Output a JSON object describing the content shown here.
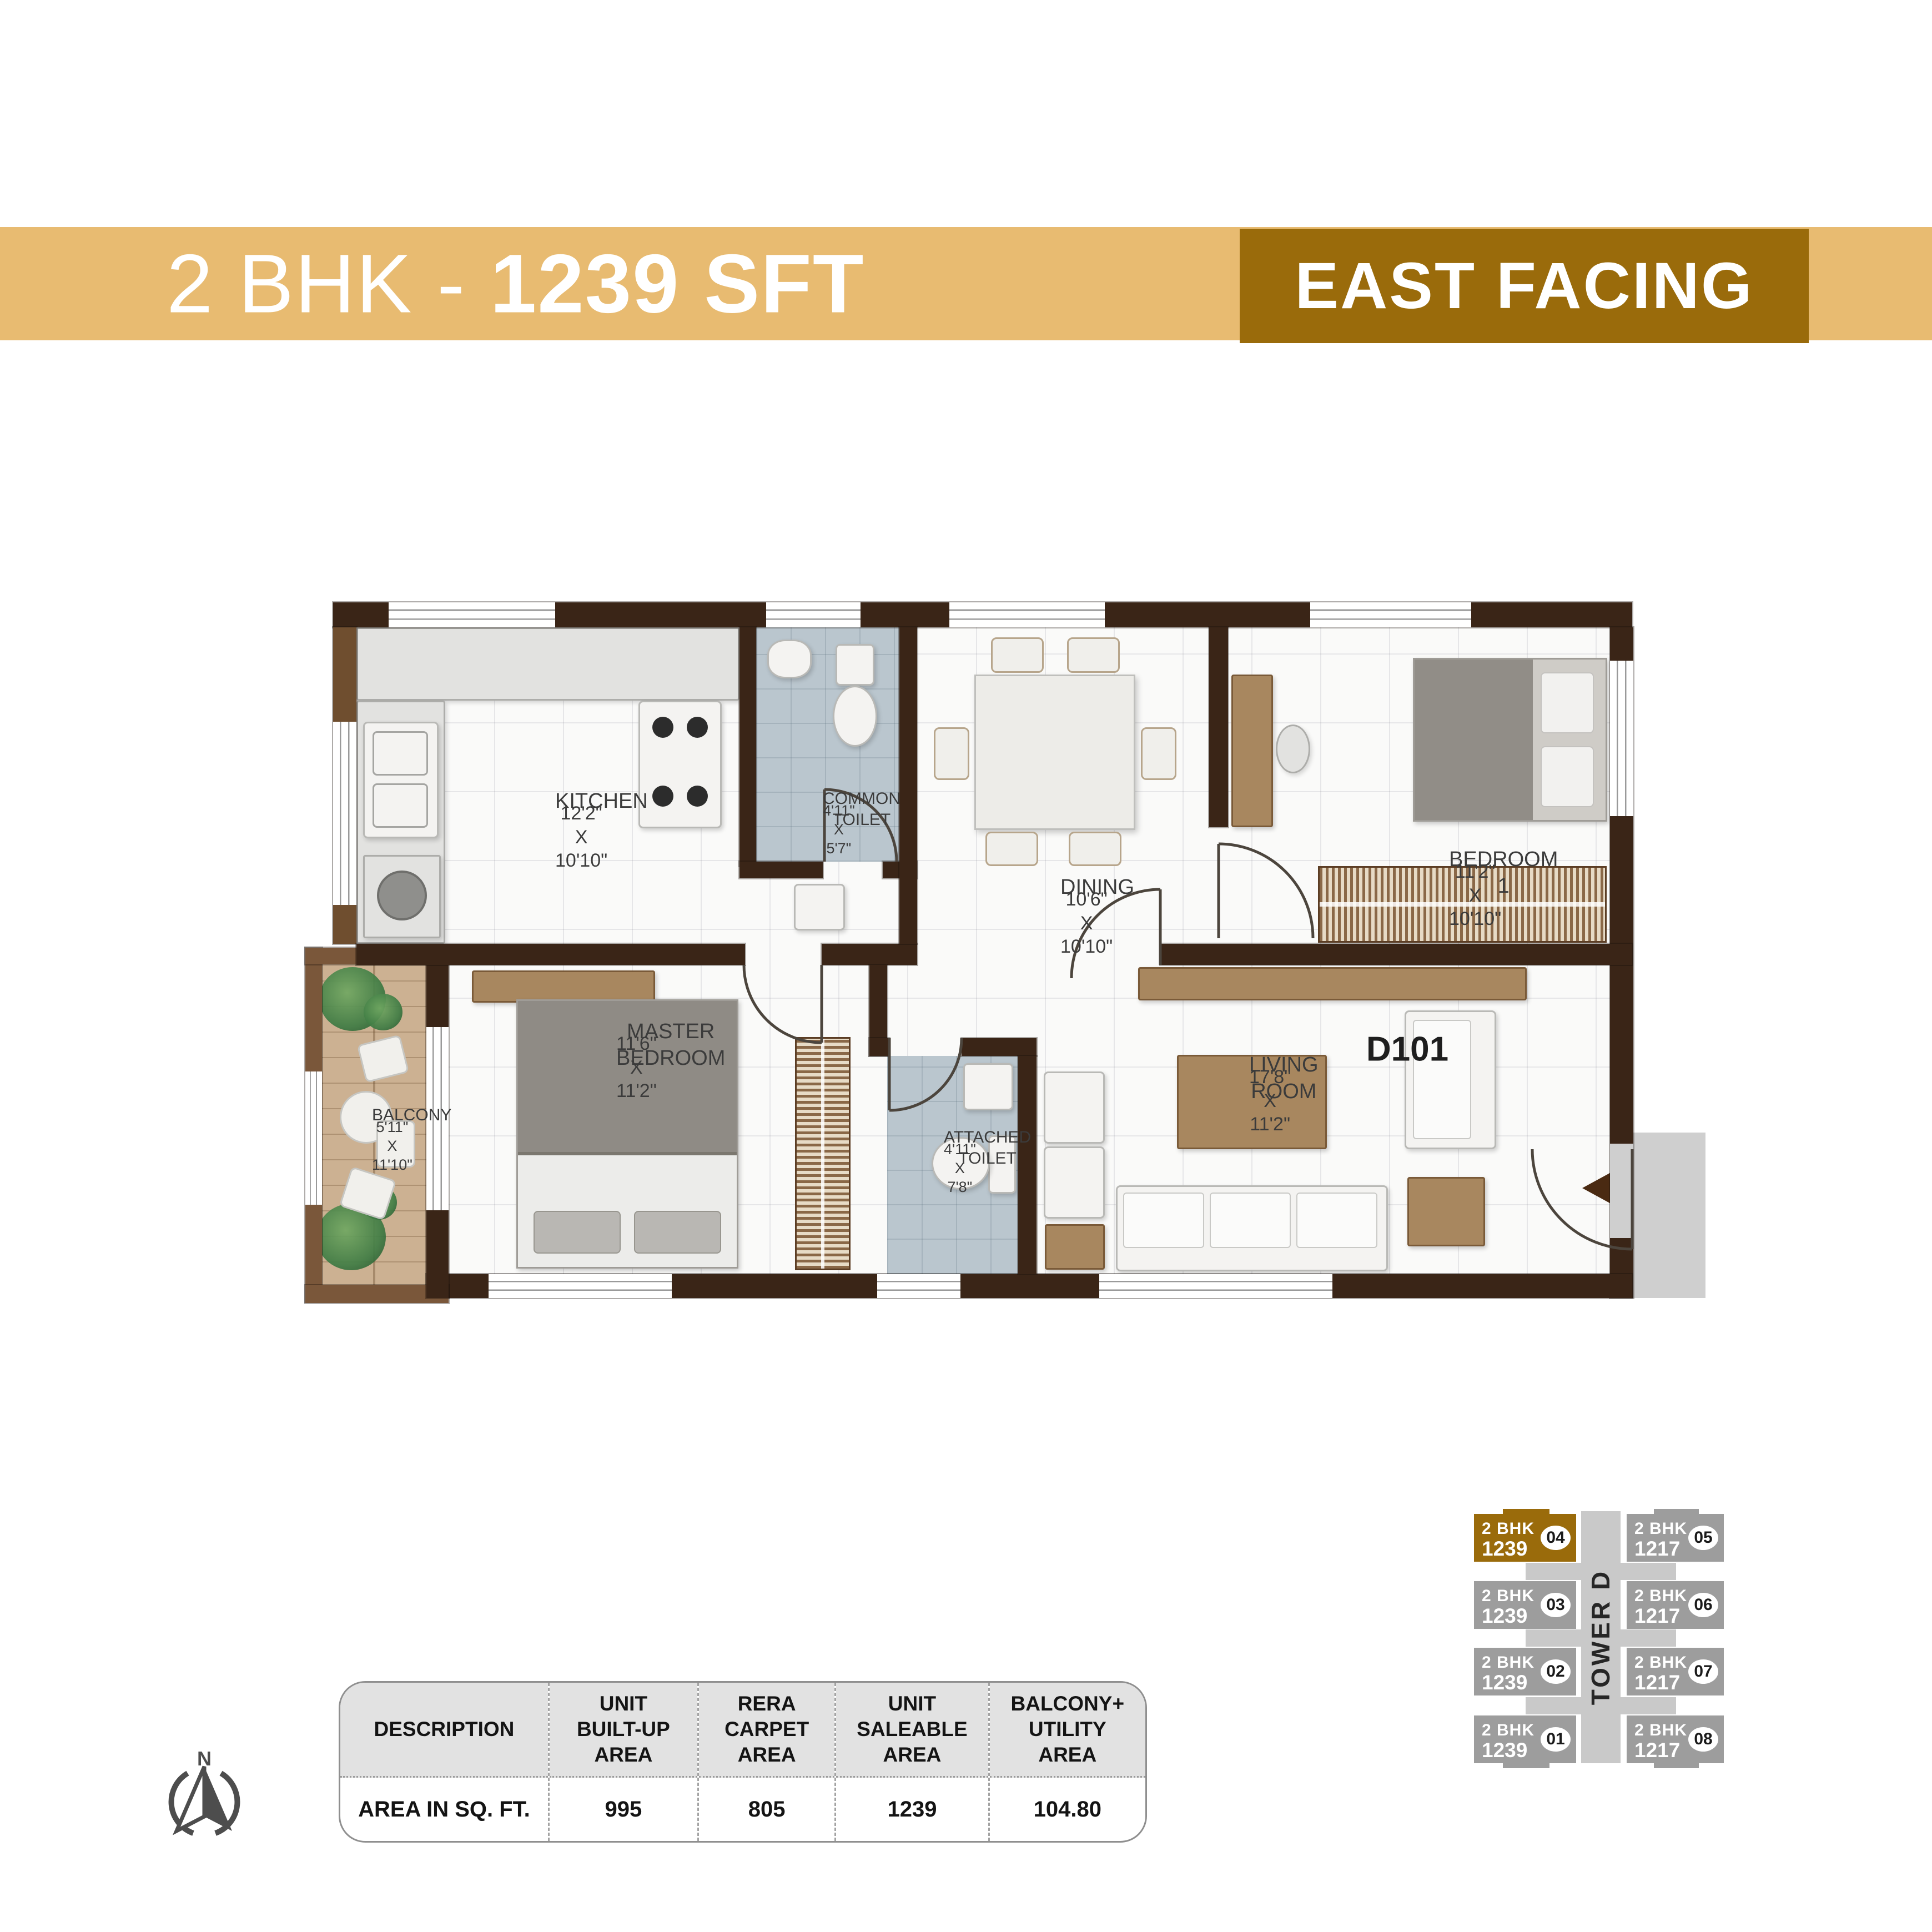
{
  "header": {
    "band_color": "#e8bb71",
    "title_prefix": "2 BHK - ",
    "title_bold": "1239 SFT",
    "facing_label": "EAST FACING",
    "facing_bg": "#9a6b0b"
  },
  "floor_plan": {
    "unit_label": "D101",
    "wall_color": "#3a2517",
    "toilet_floor_color": "#bac6ce",
    "balcony_floor_color": "#ccb192",
    "rooms": {
      "kitchen": {
        "name": "KITCHEN",
        "dims": "12'2\" X 10'10\""
      },
      "common_toilet": {
        "name": "COMMON\nTOILET",
        "dims": "4'11\" X 5'7\""
      },
      "dining": {
        "name": "DINING",
        "dims": "10'6\" X 10'10\""
      },
      "bedroom1": {
        "name": "BEDROOM 1",
        "dims": "11'2\" X 10'10\""
      },
      "master_bedroom": {
        "name": "MASTER\nBEDROOM",
        "dims": "11'6\" X  11'2\""
      },
      "balcony": {
        "name": "BALCONY",
        "dims": "5'11\" X 11'10\""
      },
      "attached_toilet": {
        "name": "ATTACHED\nTOILET",
        "dims": "4'11\" X 7'8\""
      },
      "living_room": {
        "name": "LIVING ROOM",
        "dims": "17'8\"  X 11'2\""
      }
    }
  },
  "area_table": {
    "columns": [
      "DESCRIPTION",
      "UNIT\nBUILT-UP\nAREA",
      "RERA\nCARPET\nAREA",
      "UNIT\nSALEABLE\nAREA",
      "BALCONY+\nUTILITY\nAREA"
    ],
    "row_label": "AREA IN SQ. FT.",
    "values": [
      "995",
      "805",
      "1239",
      "104.80"
    ]
  },
  "key_plan": {
    "tower_label": "TOWER D",
    "highlight_color": "#9a6b0b",
    "block_color": "#9d9d9d",
    "units": {
      "u04": {
        "no": "04",
        "type": "2 BHK",
        "area": "1239",
        "highlighted": true
      },
      "u05": {
        "no": "05",
        "type": "2 BHK",
        "area": "1217",
        "highlighted": false
      },
      "u03": {
        "no": "03",
        "type": "2 BHK",
        "area": "1239",
        "highlighted": false
      },
      "u06": {
        "no": "06",
        "type": "2 BHK",
        "area": "1217",
        "highlighted": false
      },
      "u02": {
        "no": "02",
        "type": "2 BHK",
        "area": "1239",
        "highlighted": false
      },
      "u07": {
        "no": "07",
        "type": "2 BHK",
        "area": "1217",
        "highlighted": false
      },
      "u01": {
        "no": "01",
        "type": "2 BHK",
        "area": "1239",
        "highlighted": false
      },
      "u08": {
        "no": "08",
        "type": "2 BHK",
        "area": "1217",
        "highlighted": false
      }
    }
  },
  "compass": {
    "north_label": "N"
  }
}
